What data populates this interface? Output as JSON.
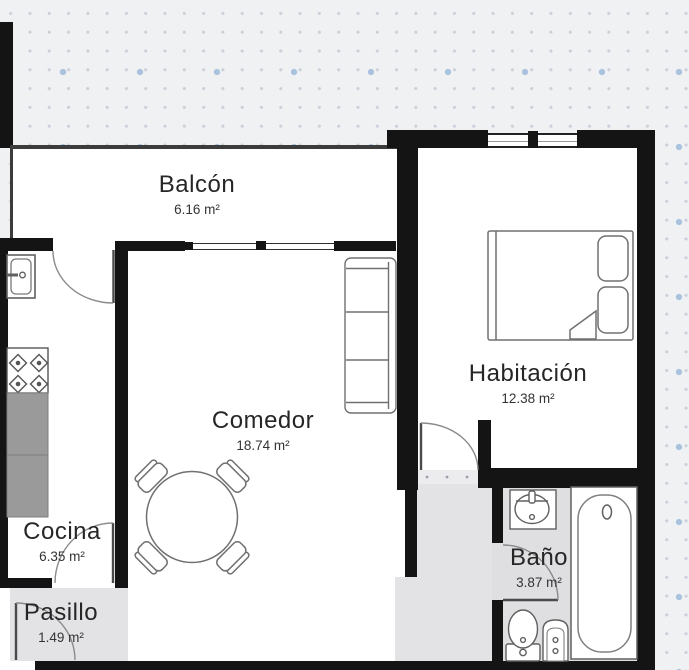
{
  "plan": {
    "type": "floor-plan",
    "rooms": [
      {
        "name": "Balcón",
        "area": "6.16 m²"
      },
      {
        "name": "Comedor",
        "area": "18.74 m²"
      },
      {
        "name": "Habitación",
        "area": "12.38 m²"
      },
      {
        "name": "Cocina",
        "area": "6.35 m²"
      },
      {
        "name": "Baño",
        "area": "3.87 m²"
      },
      {
        "name": "Pasillo",
        "area": "1.49 m²"
      }
    ],
    "colors": {
      "wall": "#141414",
      "room_floor": "#ffffff",
      "corridor_floor": "#e3e3e5",
      "bathroom_floor": "#dfdfe1",
      "counter_gray": "#9a9a9a",
      "canvas_background": "#f0f1f2",
      "grid_dot": "#c9d0da",
      "grid_diamond": "#a9c2de",
      "furniture_line": "#707070"
    }
  }
}
